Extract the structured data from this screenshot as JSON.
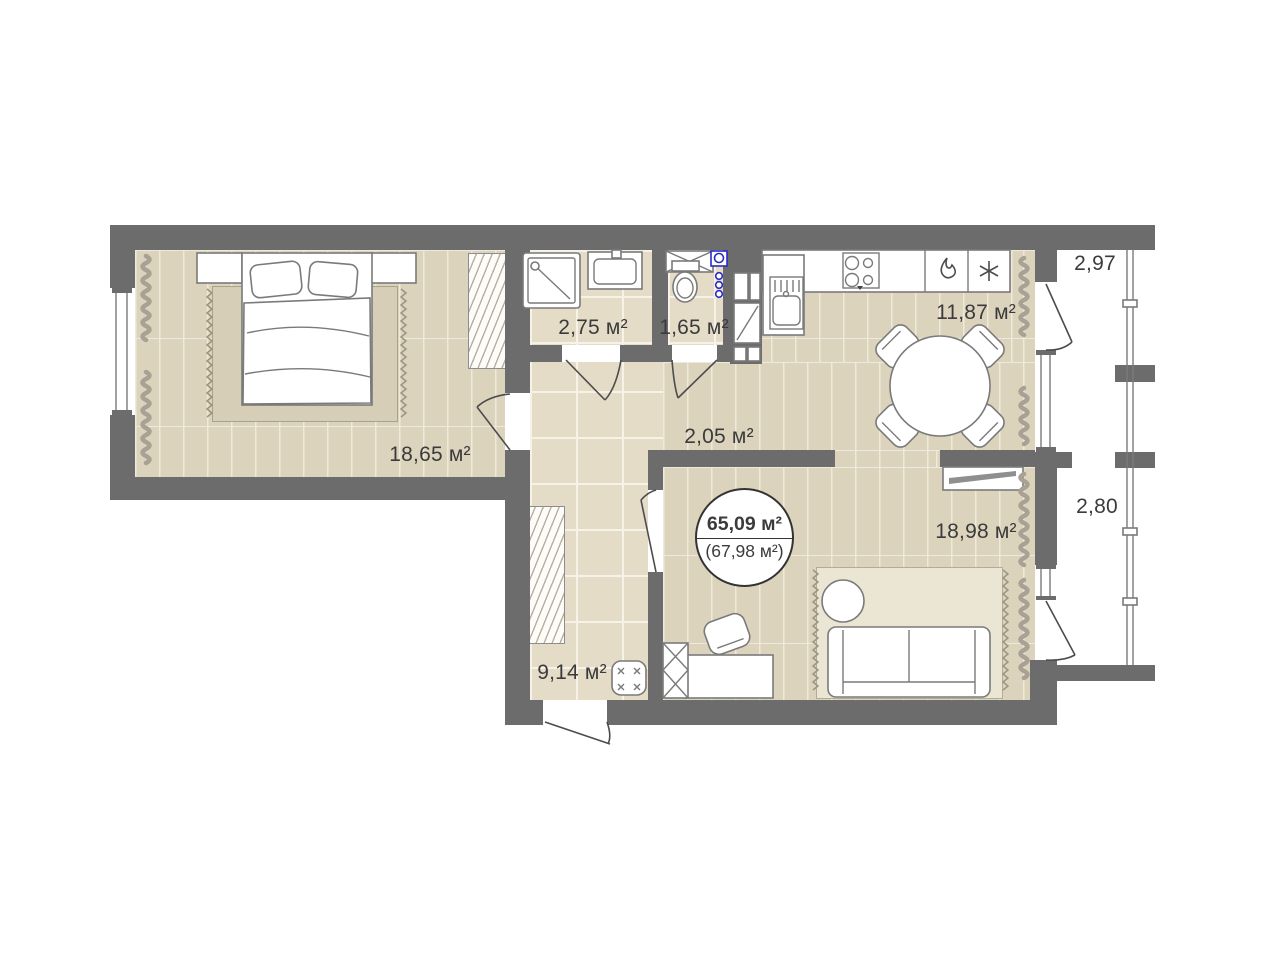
{
  "floorplan": {
    "total": {
      "main": "65,09 м²",
      "secondary": "(67,98 м²)"
    },
    "rooms": {
      "bedroom": {
        "label": "18,65 м²"
      },
      "bathroom": {
        "label": "2,75 м²"
      },
      "wc": {
        "label": "1,65 м²"
      },
      "kitchen": {
        "label": "11,87 м²"
      },
      "hall": {
        "label": "2,05 м²"
      },
      "corridor": {
        "label": "9,14 м²"
      },
      "living": {
        "label": "18,98 м²"
      },
      "balcony_top": {
        "label": "2,97"
      },
      "balcony_bottom": {
        "label": "2,80"
      }
    },
    "colors": {
      "wall": "#6c6c6c",
      "plank": "#dcd3bd",
      "plank_line": "#efe9da",
      "tile": "#e4dcc7",
      "tile_line": "#f6f2e7",
      "text": "#3b3b3b",
      "line": "#7a7a7a",
      "door": "#4c4c4c",
      "blue": "#2b2bc8",
      "rug_dark": "#d7ceb7",
      "rug_light": "#ebe5d3"
    }
  }
}
